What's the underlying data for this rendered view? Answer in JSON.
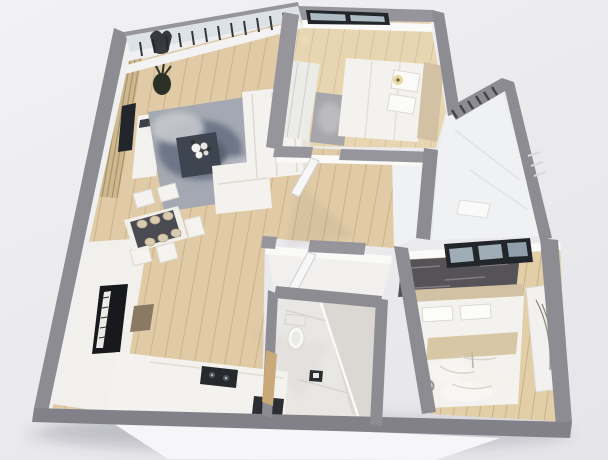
{
  "scene": {
    "label": "3D rendered bird's-eye floor plan of a small apartment",
    "view": "isometric top-down render",
    "background": "#ebebee"
  },
  "palette": {
    "bg": "#ebebee",
    "wall": "#8d8c92",
    "wallDark": "#828189",
    "wallLight": "#96959c",
    "floorWood": "#e0cba6",
    "floorWoodLight": "#e8d6b2",
    "floorWoodMaster": "#e2cfa8",
    "floorWhite": "#f0f1f3",
    "marble": "#e9e7e4",
    "marbleDark": "#dbd7d3",
    "furnitureWhite": "#f4f2ee",
    "dark": "#22262b",
    "rugBlue": "#a3a8b2",
    "rugBlueDark": "#6e7687",
    "rugCharcoal": "#565358",
    "beige": "#d2c1a2",
    "woodSlat": "#cdb88f",
    "doorTan": "#c9a879",
    "benchBrown": "#8a7a64",
    "lampWarm": "#e8d7a0",
    "glass": "#dde2e6",
    "shadow": "rgba(70,70,90,0.16)"
  },
  "rooms": {
    "living": {
      "label": "Living room",
      "furniture": [
        "slat-accent-wall",
        "wall-tv",
        "media-console",
        "blue-area-rug",
        "coffee-table",
        "flower-bouquet",
        "corner-sofa",
        "floor-plant",
        "window-with-blinds"
      ]
    },
    "dining": {
      "label": "Dining area",
      "furniture": [
        "dining-table",
        "five-chairs",
        "six-place-settings"
      ]
    },
    "piano_corner": {
      "label": "Piano corner",
      "furniture": [
        "upright-piano",
        "piano-bench",
        "white-rug"
      ]
    },
    "kitchen": {
      "label": "Kitchen",
      "furniture": [
        "l-shaped-counter",
        "cooktop",
        "sink-unit"
      ]
    },
    "bedroom_small": {
      "label": "Small bedroom",
      "furniture": [
        "double-bed",
        "pillows",
        "beige-headboard",
        "wardrobe",
        "gray-bedside-rug",
        "wall-lamp",
        "black-frame-window"
      ]
    },
    "bedroom_master": {
      "label": "Master bedroom",
      "furniture": [
        "double-bed",
        "pillows",
        "throw-blanket",
        "charcoal-rug",
        "mirror-wardrobe",
        "floor-lamp",
        "black-frame-window",
        "rumpled-duvet"
      ]
    },
    "bathroom": {
      "label": "Bathroom",
      "furniture": [
        "toilet",
        "walk-in-shower",
        "floor-drain",
        "marble-tiling",
        "wooden-door"
      ]
    },
    "hallway": {
      "label": "Hallway",
      "furniture": [
        "open-white-door"
      ]
    },
    "balcony": {
      "label": "Utility balcony",
      "furniture": [
        "louver-vent",
        "white-shelf"
      ]
    }
  },
  "structure": {
    "outer_walls": "gray-concrete-cut-walls",
    "doors": [
      "small-bedroom-door-open",
      "storage-door-open",
      "bathroom-wood-door",
      "master-door-opening"
    ],
    "windows": [
      "living-blinds-window",
      "small-bedroom-window",
      "master-window"
    ]
  }
}
